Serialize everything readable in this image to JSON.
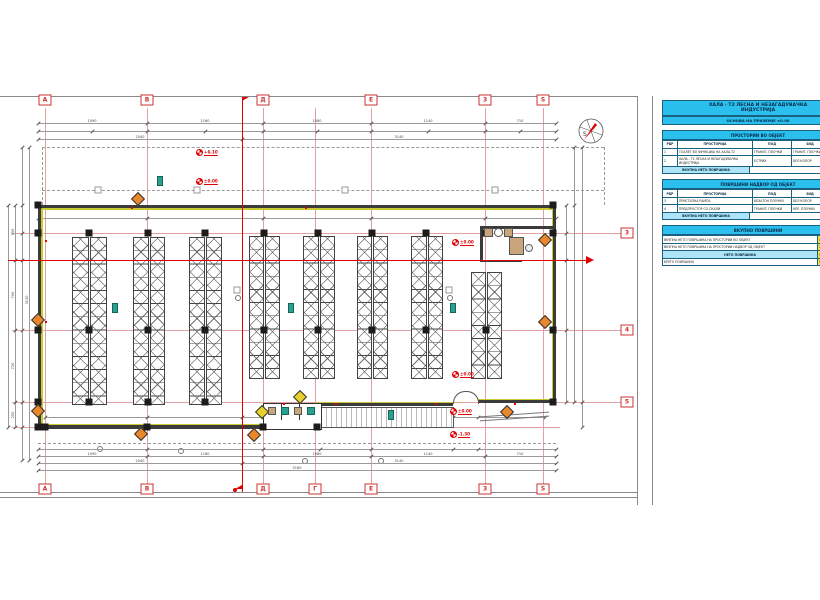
{
  "colors": {
    "accent_cyan": "#2bbfee",
    "accent_yellow": "#f1e338",
    "grid_red": "#e2a1a1",
    "section_red": "#e00000",
    "wall_insulation": "#c9c932",
    "diamond_orange": "#e8872b",
    "diamond_yellow": "#e8d22a"
  },
  "title_block": {
    "title_line1": "ХАЛА - Т2 ЛЕСНА И НЕЗАГАДУВАЧКА",
    "title_line2": "ИНДУСТРИЈА",
    "subtitle": "ОСНОВА НА ПРИЗЕМЈЕ ±0.00",
    "table_rooms": {
      "header": "ПРОСТОРИИ ВО ОБЈЕКТ",
      "columns": [
        "РБР",
        "ПРОСТОРИЈА",
        "ПОД",
        "ЅИД",
        "м²"
      ],
      "rows": [
        [
          "1",
          "ТОАЛЕТ ВО ФУНКЦИЈА НА ХАЛА-Т2",
          "ГРАНИТ. ПЛОЧКИ",
          "ГРАНИТ. ПЛОЧКИ",
          "4,70"
        ],
        [
          "2",
          "ХАЛА - Т2 ЛЕСНА И НЕЗАГАДУВАЧКА ИНДУСТРИЈА",
          "ЕСТРИХ",
          "БЕЛ КОЛОР",
          "476,85"
        ]
      ],
      "footer_label": "ВКУПНА НЕТО ПОВРШИНА",
      "footer_value": "481,55"
    },
    "table_outside": {
      "header": "ПОВРШИНИ НАДВОР ОД ОБЈЕКТ",
      "columns": [
        "РБР",
        "ПРОСТОРИЈА",
        "ПОД",
        "ЅИД",
        "м²"
      ],
      "rows": [
        [
          "3",
          "ПРИСТАПНА РАМПА",
          "БЕХАТОН ПЛОЧКИ",
          "БЕЛ КОЛОР",
          "15,40"
        ],
        [
          "4",
          "ПРЕДПРОСТОР СО СКАЛИ",
          "ГРАНИТ. ПЛОЧКИ",
          "КЕР. ПЛОЧКИ",
          "5,60"
        ]
      ],
      "footer_label": "ВКУПНА НЕТО ПОВРШИНА",
      "footer_value": "21,00"
    },
    "table_totals": {
      "header": "ВКУПНО ПОВРШИНИ",
      "rows": [
        [
          "ВКУПНА НЕТО ПОВРШИНА НА ПРОСТОРИИ ВО ОБЈЕКТ",
          "481,55"
        ],
        [
          "ВКУПНА НЕТО ПОВРШИНА НА ПРОСТОРИИ НАДВОР ОД ОБЈЕКТ",
          "21,00"
        ],
        [
          "НЕТО ПОВРШИНА",
          "502,55"
        ],
        [
          "БРУТО ПОВРШИНА",
          "516,70"
        ]
      ]
    }
  },
  "grid": {
    "top_labels": [
      "А",
      "В",
      "Д",
      "Е",
      "З",
      "Ѕ"
    ],
    "bottom_labels": [
      "А",
      "В",
      "Д",
      "Г",
      "Е",
      "З",
      "Ѕ"
    ],
    "right_labels": [
      "3",
      "4",
      "5"
    ]
  },
  "levels": [
    "+6.10",
    "±0.00",
    "±0.00",
    "±0.00",
    "±0.00",
    "-1.30"
  ],
  "compass": {
    "label": "S"
  },
  "dims": {
    "top_segments": [
      "1090",
      "1160",
      "1080",
      "1140",
      "710"
    ],
    "top_halves": [
      "2040",
      "3140"
    ],
    "bottom_segments": [
      "1090",
      "1160",
      "1080",
      "1140",
      "710"
    ],
    "bottom_halves": [
      "2040",
      "3140"
    ],
    "bottom_total": "5180",
    "left_segments": [
      "550",
      "700",
      "720",
      "250"
    ],
    "left_total": "3130"
  }
}
